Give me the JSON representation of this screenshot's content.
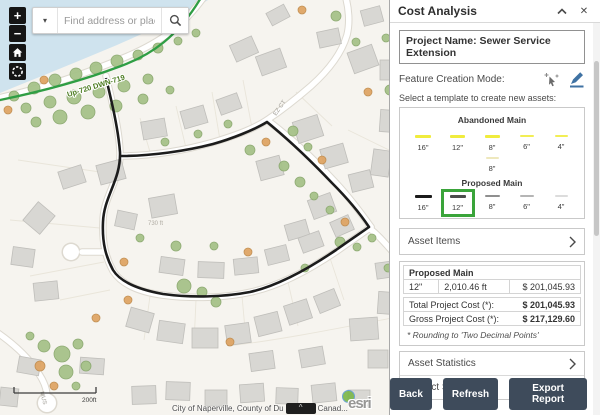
{
  "map": {
    "search": {
      "placeholder": "Find address or place",
      "caret": "▾"
    },
    "controls": {
      "zoom_in": "+",
      "zoom_out": "−"
    },
    "labels": {
      "sewer_main": "Up-720 DWN-719",
      "street_ct": "EZ CT",
      "street_mus": "MUS",
      "parcel_dim": "730 ft",
      "scale": "200ft"
    },
    "attribution": {
      "text_left": "City of Naperville, County of Du",
      "widget": "^",
      "text_right": "Canad...",
      "logo": "esri"
    }
  },
  "panel": {
    "title": "Cost Analysis",
    "header_icons": {
      "close": "✕"
    },
    "project_name": "Project Name: Sewer Service Extension",
    "feature_mode_label": "Feature Creation Mode:",
    "template_prompt": "Select a template to create new assets:",
    "templates": {
      "abandoned": {
        "title": "Abandoned Main",
        "items": [
          {
            "label": "16\"",
            "style": "background:#f0ec3d;height:2.5px;width:16px"
          },
          {
            "label": "12\"",
            "style": "background:#f0ec3d;height:2.5px;width:15px"
          },
          {
            "label": "8\"",
            "style": "background:#f0ec3d;height:2.5px;width:15px"
          },
          {
            "label": "6\"",
            "style": "background:#f2ee55;height:2px;width:14px"
          },
          {
            "label": "4\"",
            "style": "background:#f2ee55;height:2px;width:13px"
          }
        ],
        "extra_item": {
          "label": "8\"",
          "style": "background:#eee8bd;height:2px;width:13px"
        }
      },
      "proposed": {
        "title": "Proposed Main",
        "items": [
          {
            "label": "16\"",
            "style": "background:#1b1b1b;height:3.5px;width:17px"
          },
          {
            "label": "12\"",
            "style": "background:#4c4c4c;height:3px;width:16px"
          },
          {
            "label": "8\"",
            "style": "background:#8f8f8f;height:2.5px;width:15px"
          },
          {
            "label": "6\"",
            "style": "background:#b5b5b5;height:2px;width:14px"
          },
          {
            "label": "4\"",
            "style": "background:#dcdcdc;height:2px;width:13px"
          }
        ],
        "selected_index": 1
      },
      "valves": {
        "title": "Proposed Valves"
      }
    },
    "sections": {
      "asset_items": "Asset Items",
      "asset_statistics": "Asset Statistics",
      "project_summary": "Project Summary"
    },
    "asset_table": {
      "group": "Proposed Main",
      "rows": [
        {
          "size": "12\"",
          "length": "2,010.46 ft",
          "cost": "$ 201,045.93"
        }
      ],
      "total_label": "Total Project Cost (*):",
      "total_value": "$ 201,045.93",
      "gross_label": "Gross Project Cost (*):",
      "gross_value": "$ 217,129.60",
      "footnote": "* Rounding to 'Two Decimal Points'"
    },
    "buttons": {
      "back": "Back",
      "refresh": "Refresh",
      "export": "Export Report"
    },
    "colors": {
      "button_bg": "#3e4b5b",
      "selection_green": "#3aa43a",
      "pencil_blue": "#3f72a3",
      "abandoned_yellow": "#f0ec3d",
      "sewer_green": "#2f9e44",
      "proposed_black": "#1c1c1c",
      "water": "#cfe3ee"
    }
  }
}
